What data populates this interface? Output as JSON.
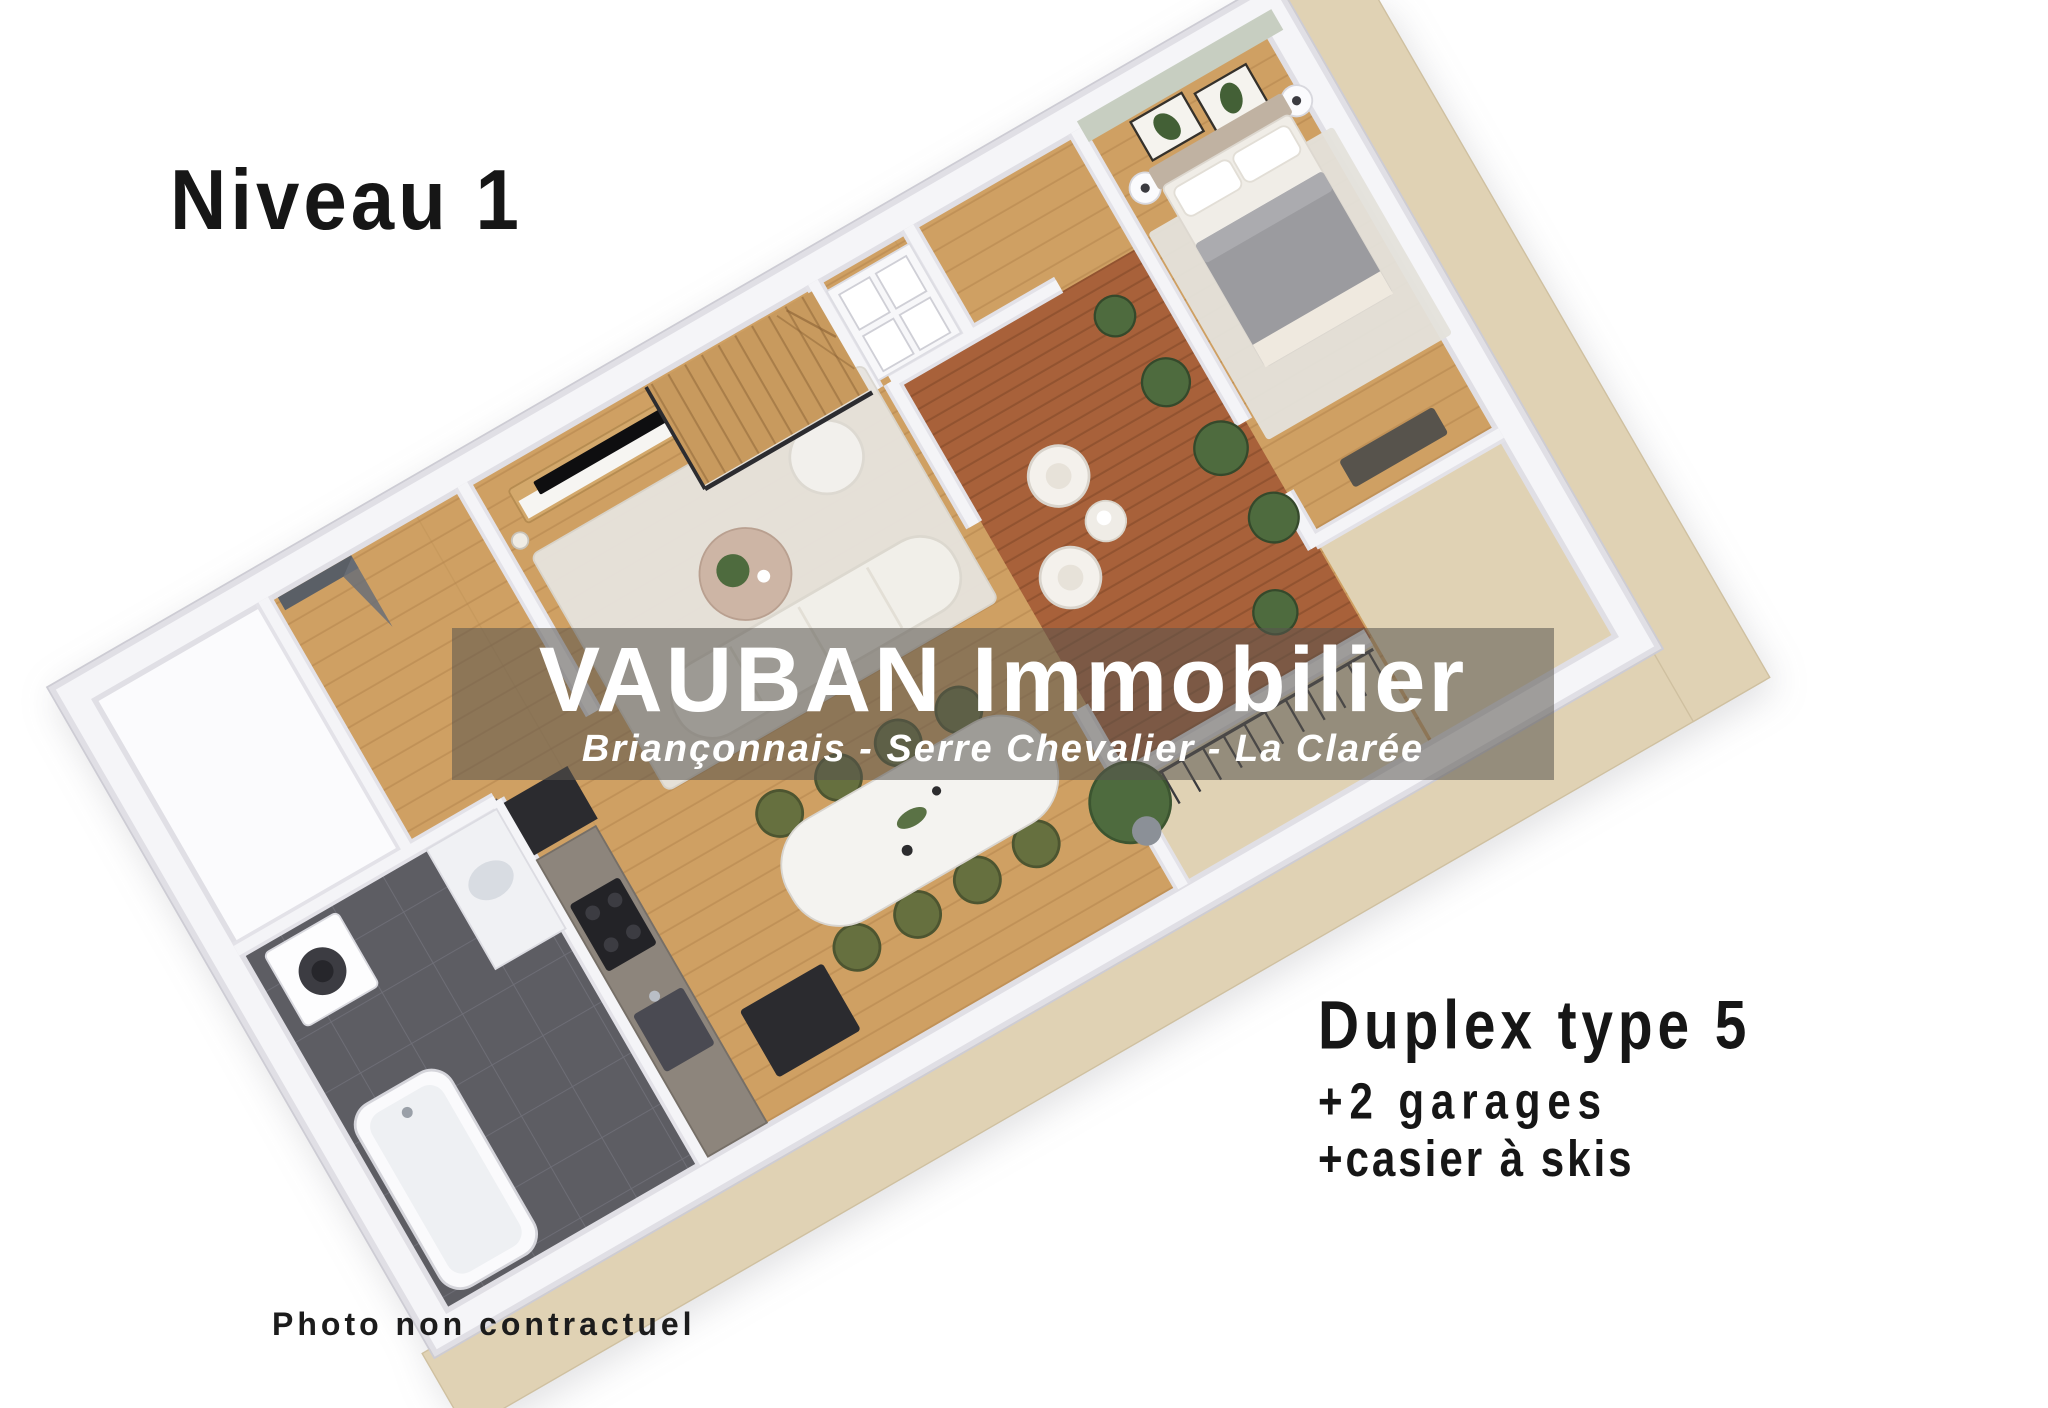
{
  "level": {
    "label": "Niveau 1"
  },
  "watermark": {
    "title": "VAUBAN Immobilier",
    "subtitle": "Briançonnais - Serre Chevalier - La Clarée"
  },
  "unit": {
    "title": "Duplex type 5",
    "extra_garages": "+2 garages",
    "extra_ski_locker": "+casier à skis"
  },
  "footer": {
    "disclaimer": "Photo non contractuel"
  },
  "palette": {
    "text_dark": "#161616",
    "watermark_text": "#ffffff",
    "watermark_overlay": "#55524e",
    "wood_floor": "#cfa063",
    "wood_plank_line": "#b4854c",
    "terrace_deck": "#a8613a",
    "deck_plank_line": "#7c4526",
    "bathroom_tile": "#5d5d63",
    "tile_grout": "#73737c",
    "wall_white": "#f5f5f8",
    "wall_edge": "#e0dfe5",
    "accent_wall_sage": "#c7cec1",
    "base_plinth": "#e0d2b4",
    "rug_light": "#e7e4de",
    "sofa_white": "#f1efe9",
    "dining_chair_olive": "#66703f",
    "plant_green": "#4e6b3e",
    "stair_wood": "#c89a5e",
    "appliance_dark": "#2b2b2f"
  }
}
